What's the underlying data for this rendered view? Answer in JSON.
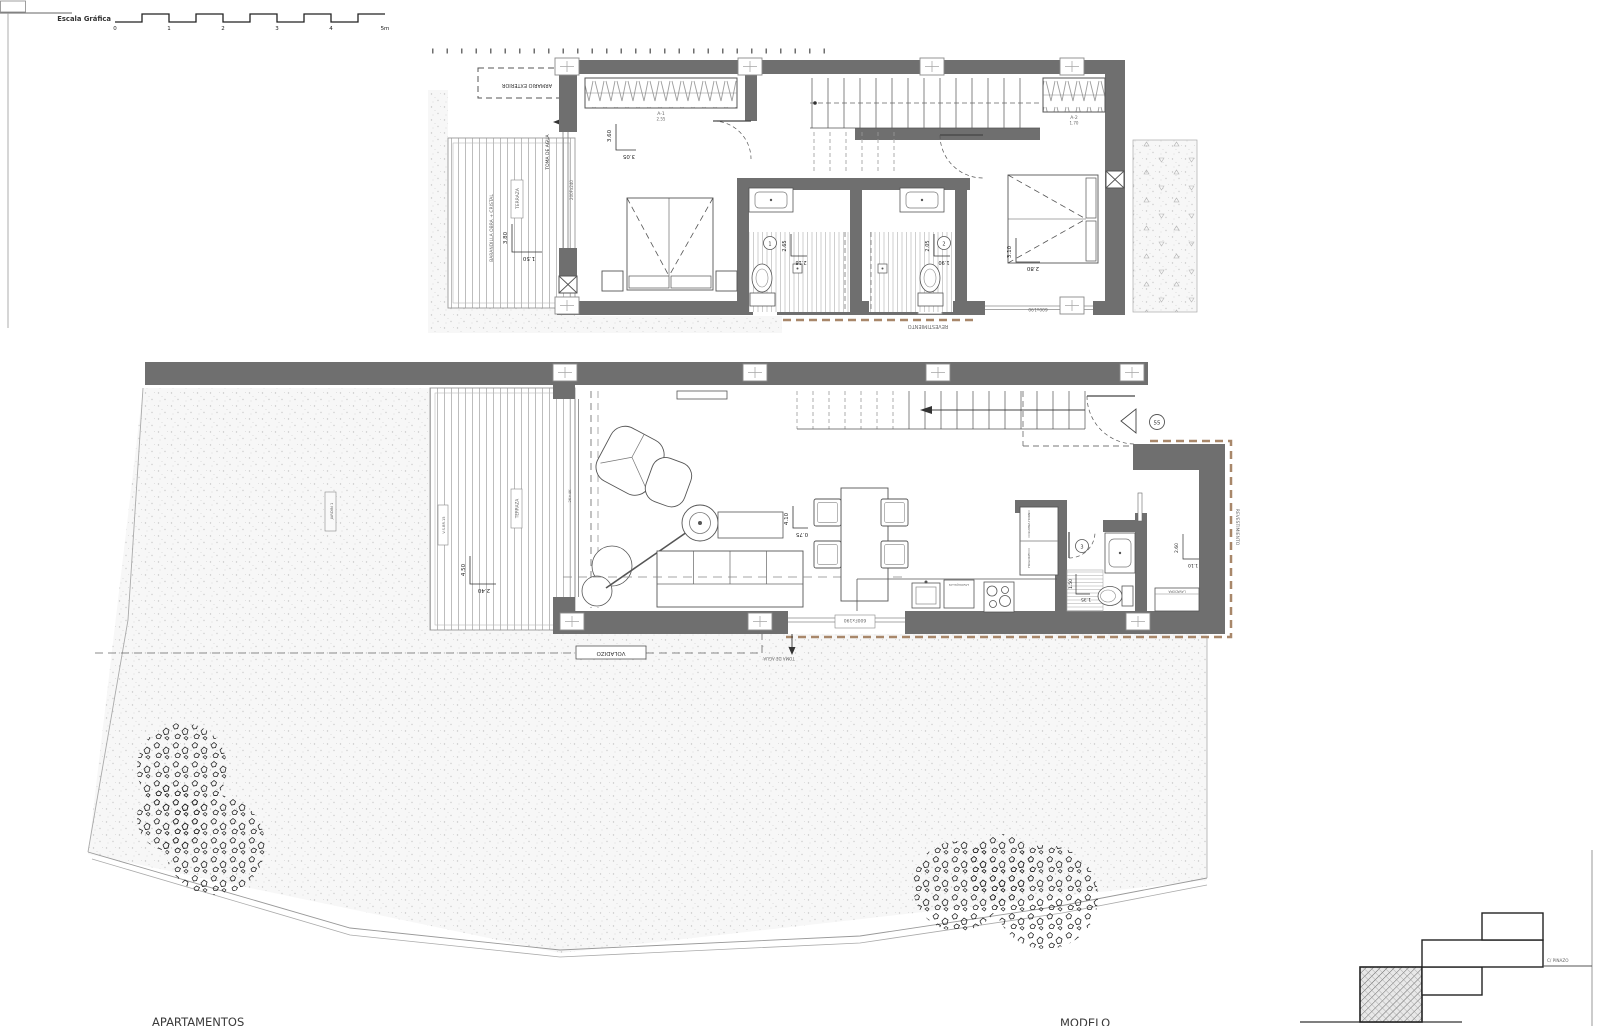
{
  "scale_bar": {
    "title": "Escala Gráfica",
    "ticks": {
      "t0": "0",
      "t1": "1",
      "t2": "2",
      "t3": "3",
      "t4": "4",
      "t5": "5m"
    }
  },
  "upper_floor": {
    "terrace": {
      "armario_exterior": "ARMARIO EXTERIOR",
      "toma_agua": "TOMA DE AGUA",
      "barandilla": "BARANDILLA OBRA + CRISTAL",
      "terraza": "TERRAZA",
      "glass_code": "200Fx240",
      "dim_a": "3.80",
      "dim_b": "1.50"
    },
    "bedroom1": {
      "dim_a": "3.60",
      "dim_b": "3.05",
      "wardrobe_name": "A-1",
      "wardrobe_val": "2.55"
    },
    "bath1": {
      "num": "1",
      "dim_a": "2.65",
      "dim_b": "2.18",
      "window_code": "50x05"
    },
    "bath2": {
      "num": "2",
      "dim_a": "2.05",
      "dim_b": "1.90"
    },
    "bedroom2": {
      "dim_a": "3.10",
      "dim_b": "2.80",
      "wardrobe_name": "A-2",
      "wardrobe_val": "1.70",
      "window_code": "600x190"
    },
    "revestimiento": "REVESTIMIENTO"
  },
  "ground_floor": {
    "garden_label": "JARDIN 1",
    "deck": {
      "code": "V.S.BR.15",
      "terraza": "TERRAZA",
      "dim_a": "4.50",
      "dim_b": "2.40",
      "glass_code": "2K+4K"
    },
    "living": {
      "dim_a": "4.10",
      "dim_b": "0.75"
    },
    "entry": {
      "marker": "55"
    },
    "kitchen": {
      "tall_unit_top": "COLUMNA HORNO",
      "tall_unit_bottom": "FRIGORIFICO",
      "dishwasher": "LAVAVAJILLAS"
    },
    "bath3": {
      "num": "3",
      "dim_a": "1.50",
      "dim_b": "1.35"
    },
    "laundry": {
      "label": "LAVADORA",
      "dim_a": "2.60",
      "dim_b": "1.10"
    },
    "window_code": "600Fx190",
    "voladizo": "VOLADIZO",
    "toma_agua": "TOMA DE AGUA",
    "revestimiento": "REVESTIMIENTO"
  },
  "key_plan": {
    "street": "C/ PINAZO"
  },
  "title_block": {
    "left": "APARTAMENTOS",
    "right": "MODELO"
  },
  "colors": {
    "wall": "#6f6f6f",
    "revestimiento_dash": "#a8876a"
  }
}
